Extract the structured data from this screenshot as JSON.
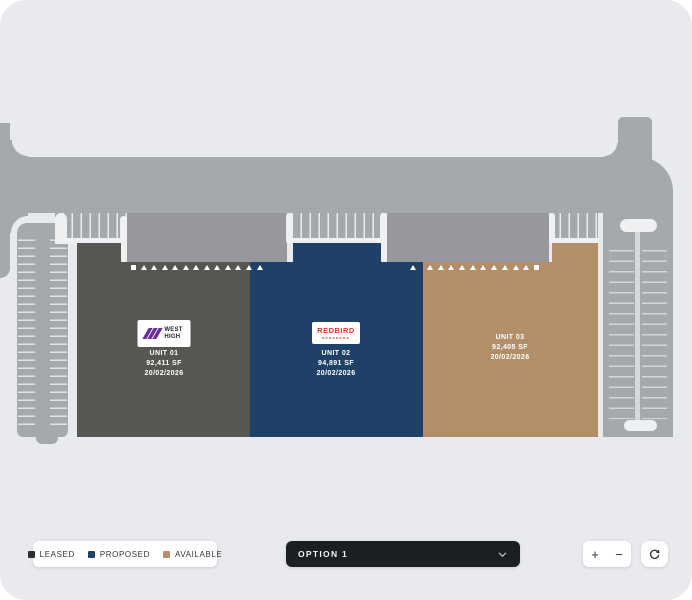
{
  "colors": {
    "background": "#e9eaed",
    "road": "#a6a9ac",
    "court": "#96989b",
    "leased": "#585653",
    "proposed": "#1f4168",
    "available": "#b28f68"
  },
  "plan": {
    "units": [
      {
        "name": "UNIT 01",
        "area": "92,411 SF",
        "date": "20/02/2026",
        "status": "LEASED",
        "logo": {
          "brand_line1": "WEST",
          "brand_line2": "HIGH"
        }
      },
      {
        "name": "UNIT 02",
        "area": "94,891 SF",
        "date": "20/02/2026",
        "status": "PROPOSED",
        "logo": {
          "brand": "REDBIRD"
        }
      },
      {
        "name": "UNIT 03",
        "area": "92,405 SF",
        "date": "20/02/2026",
        "status": "AVAILABLE"
      }
    ],
    "dock_markers": {
      "unit1": [
        "square",
        "tri",
        "tri",
        "tri",
        "tri",
        "tri",
        "tri",
        "tri",
        "tri",
        "tri",
        "tri",
        "tri"
      ],
      "unit2": [
        "tri",
        "tri"
      ],
      "unit3": [
        "tri",
        "tri",
        "tri",
        "tri",
        "tri",
        "tri",
        "tri",
        "tri",
        "tri",
        "tri",
        "square"
      ]
    }
  },
  "legend": {
    "items": [
      {
        "label": "LEASED",
        "color": "#31302e"
      },
      {
        "label": "PROPOSED",
        "color": "#1e4168"
      },
      {
        "label": "AVAILABLE",
        "color": "#b3906b"
      }
    ]
  },
  "toolbar": {
    "option_select": {
      "value": "OPTION 1"
    },
    "zoom_in": "+",
    "zoom_out": "−"
  }
}
